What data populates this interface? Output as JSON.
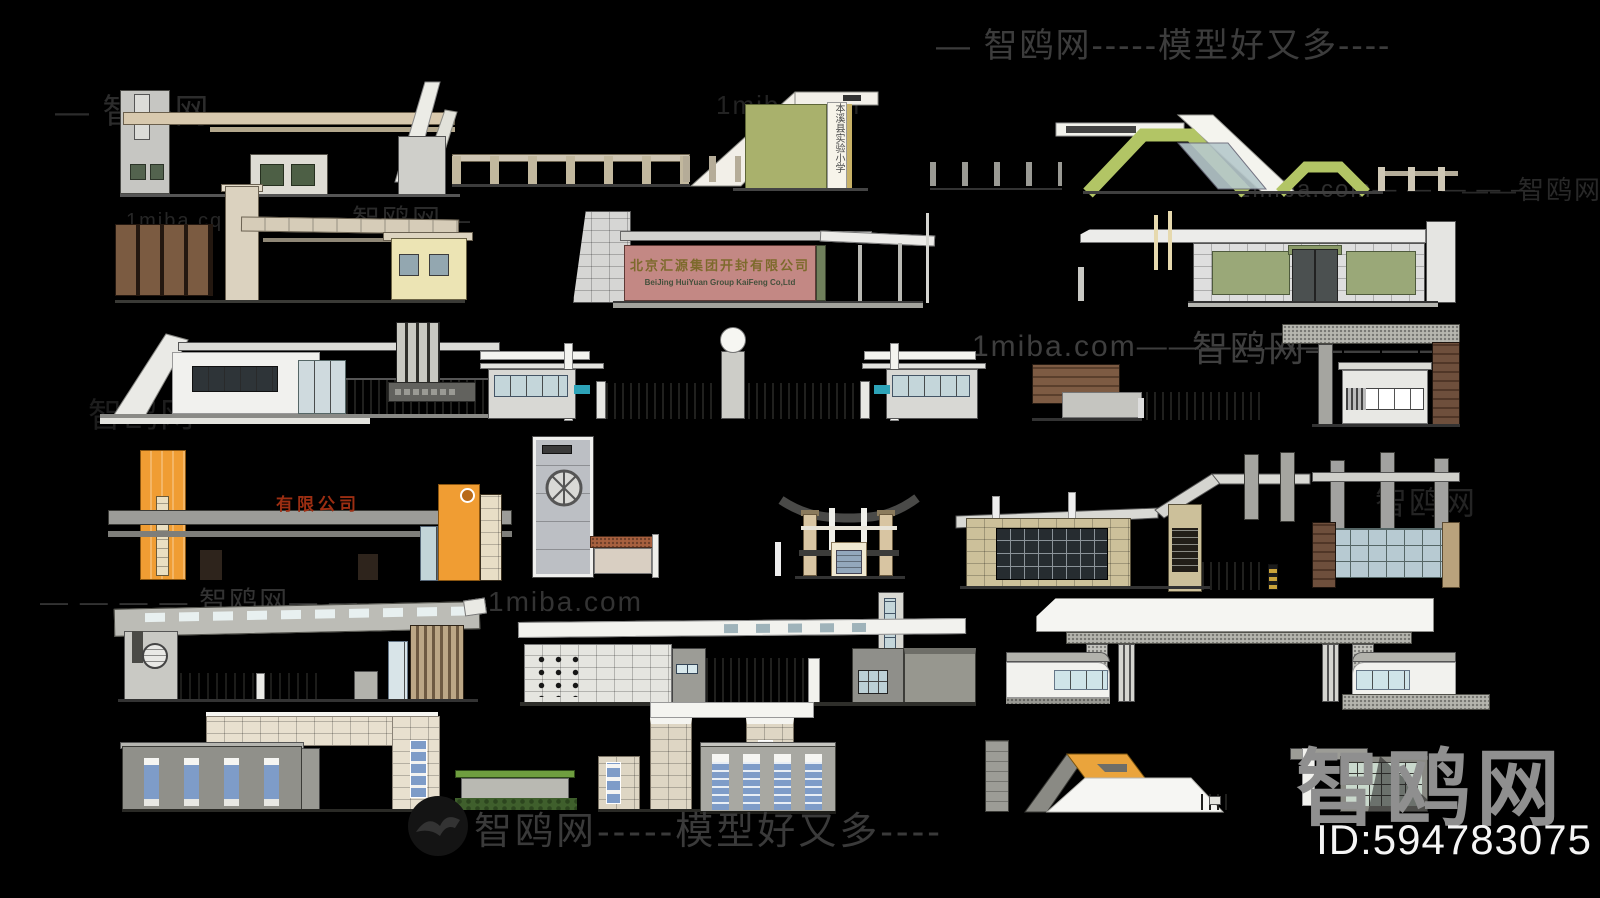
{
  "page": {
    "background": "#000000",
    "width": 1600,
    "height": 898
  },
  "watermarks": {
    "top_left": "— 智鸥网--",
    "top_left_site": "1miba.com",
    "top_banner": "— 智鸥网-----模型好又多----",
    "row1_site_left": "1miba.cq",
    "row1_brand_left": "智鸥网—",
    "row1_site_right": "1miba.com— — — — —",
    "row1_brand_right": "——智鸥网",
    "row3_brand_faint": "智鸥网",
    "row3_site": "1miba.com——————",
    "row3_brand": "智鸥网————",
    "row4_brand": "智鸥网",
    "row5_line": "— — — — 智鸥网— — — — — 1miba.com",
    "bottom_banner": "智鸥网-----模型好又多----"
  },
  "branding": {
    "logo": "智鸥网",
    "model_id": "ID:594783075"
  },
  "signs": {
    "school_vertical": "本溪县实验小学",
    "huiyuan_cn": "北京汇源集团开封有限公司",
    "huiyuan_en": "BeiJing HuiYuan Group KaiFeng Co,Ltd",
    "company": "有限公司"
  },
  "colors": {
    "background": "#000000",
    "watermark_gray": "#3a3a3a",
    "logo_gray": "#8f8f8f",
    "id_white": "#f5f5f5",
    "accent_orange": "#f09d33",
    "accent_green": "#b2c565",
    "sign_pink": "#c38884",
    "sign_red_text": "#9c2e12",
    "window_blue": "#7e9cc8",
    "olive_panel": "#a9b16c"
  },
  "models": [
    {
      "name": "beam-gate-towers"
    },
    {
      "name": "fence-a"
    },
    {
      "name": "school-gate"
    },
    {
      "name": "fence-b"
    },
    {
      "name": "green-chevron-gate"
    },
    {
      "name": "wood-panel-gate"
    },
    {
      "name": "huiyuan-sign-gate"
    },
    {
      "name": "canopy-green-panel-gate"
    },
    {
      "name": "diagonal-ramp-gate"
    },
    {
      "name": "twin-guard-booths"
    },
    {
      "name": "wood-wall"
    },
    {
      "name": "fence-c"
    },
    {
      "name": "glass-booth-gate"
    },
    {
      "name": "orange-pylon-gate"
    },
    {
      "name": "clock-tower-gate"
    },
    {
      "name": "curved-roof-gate"
    },
    {
      "name": "stone-glass-gate"
    },
    {
      "name": "column-glass-wall"
    },
    {
      "name": "skylight-beam-gate"
    },
    {
      "name": "canopy-tile-gate"
    },
    {
      "name": "white-portal-gate"
    },
    {
      "name": "l-shape-gate-building"
    },
    {
      "name": "hedge-wall"
    },
    {
      "name": "tile-pillar-gate"
    },
    {
      "name": "four-door-building"
    },
    {
      "name": "trapezoid-gate"
    },
    {
      "name": "corner-roof-building"
    }
  ]
}
